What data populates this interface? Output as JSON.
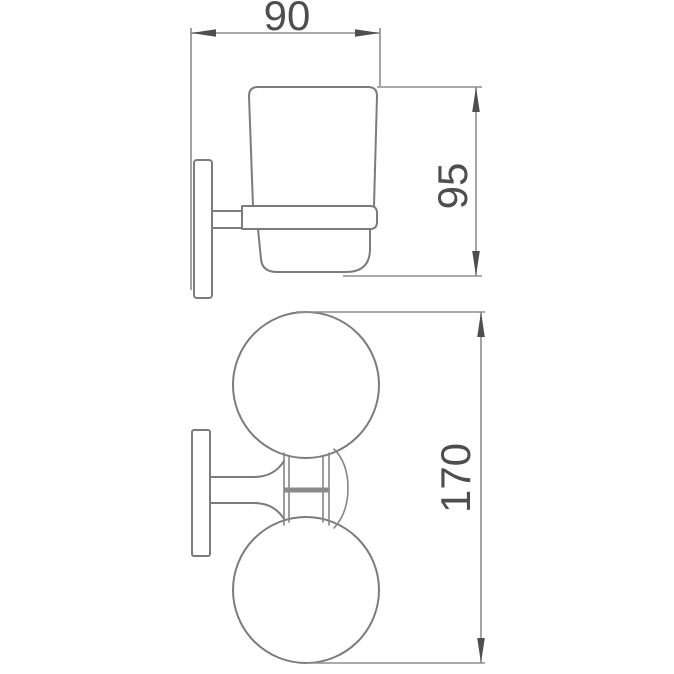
{
  "drawing": {
    "type": "technical-dimension-drawing",
    "dimensions": {
      "width": "90",
      "height": "95",
      "span": "170"
    },
    "colors": {
      "background": "#ffffff",
      "outline": "#7c7c7c",
      "dimension_line": "#8e8e8e",
      "arrow_and_text": "#4e4e4e"
    }
  }
}
